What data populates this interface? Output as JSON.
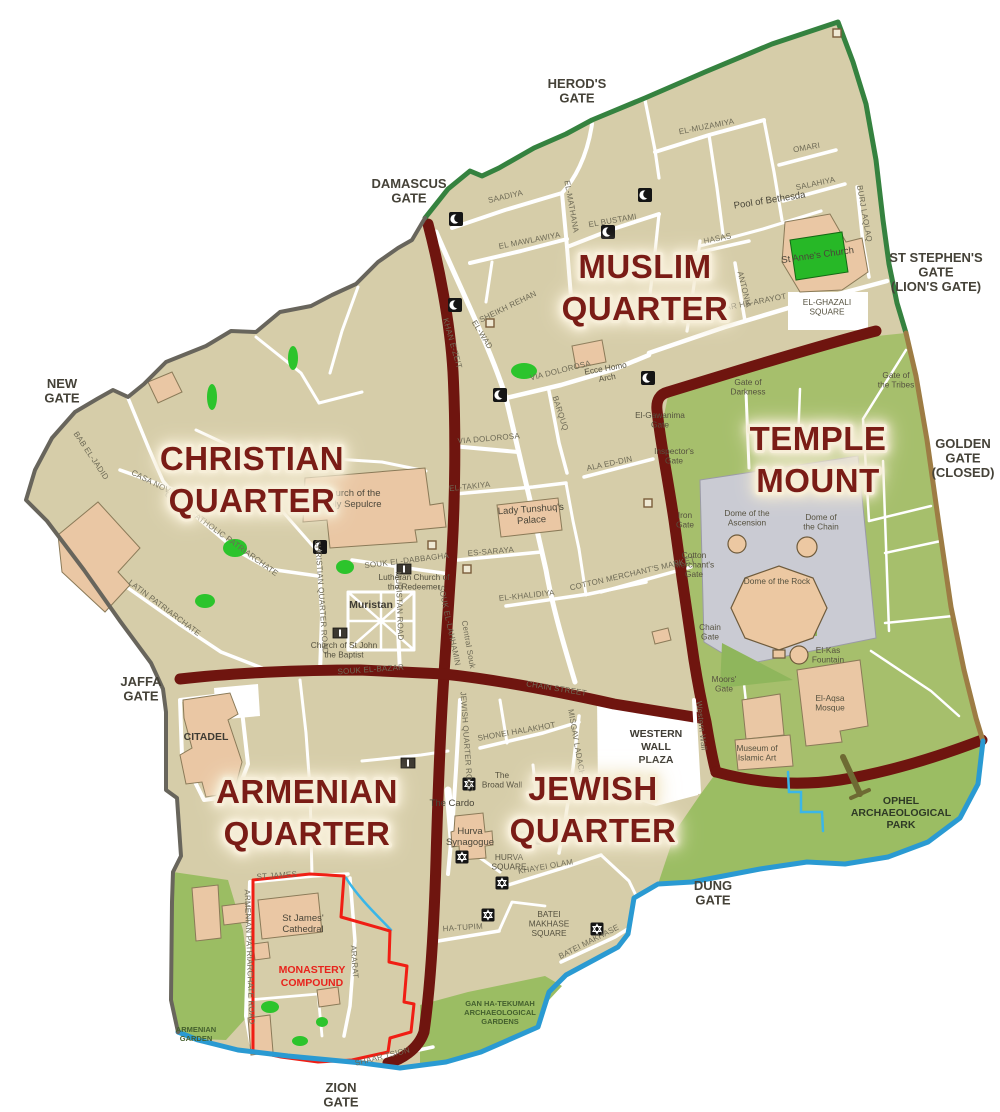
{
  "colors": {
    "background": "#ffffff",
    "land": "#d6cda9",
    "temple_mount_green": "#a6bf6c",
    "park_green": "#9bbd63",
    "tree_green": "#2cc42c",
    "building": "#eac7a4",
    "street": "#ffffff",
    "boundary_road": "#6f150f",
    "quarter_label": "#7a1e16",
    "quarter_glow": "#f6eed8",
    "wall_north": "#35823f",
    "wall_east": "#9d7c44",
    "wall_south": "#2a9ad2",
    "wall_west": "#68655c",
    "monastery_outline": "#f01e14",
    "esplanade": "#cacbd3"
  },
  "map": {
    "quarter_labels": [
      {
        "name": "muslim-quarter-label",
        "x": 645,
        "y": 278,
        "lines": [
          "MUSLIM",
          "QUARTER"
        ]
      },
      {
        "name": "christian-quarter-label",
        "x": 252,
        "y": 470,
        "lines": [
          "CHRISTIAN",
          "QUARTER"
        ]
      },
      {
        "name": "temple-mount-label",
        "x": 818,
        "y": 450,
        "lines": [
          "TEMPLE",
          "MOUNT"
        ]
      },
      {
        "name": "armenian-quarter-label",
        "x": 307,
        "y": 803,
        "lines": [
          "ARMENIAN",
          "QUARTER"
        ]
      },
      {
        "name": "jewish-quarter-label",
        "x": 593,
        "y": 800,
        "lines": [
          "JEWISH",
          "QUARTER"
        ]
      }
    ],
    "gate_labels": [
      {
        "name": "herods-gate-label",
        "x": 577,
        "y": 88,
        "lines": [
          "HEROD'S",
          "GATE"
        ]
      },
      {
        "name": "damascus-gate-label",
        "x": 409,
        "y": 188,
        "lines": [
          "DAMASCUS",
          "GATE"
        ]
      },
      {
        "name": "st-stephens-gate-label",
        "x": 936,
        "y": 262,
        "lines": [
          "ST STEPHEN'S",
          "GATE",
          "(LION'S GATE)"
        ]
      },
      {
        "name": "golden-gate-label",
        "x": 963,
        "y": 448,
        "lines": [
          "GOLDEN",
          "GATE",
          "(CLOSED)"
        ]
      },
      {
        "name": "new-gate-label",
        "x": 62,
        "y": 388,
        "lines": [
          "NEW",
          "GATE"
        ]
      },
      {
        "name": "jaffa-gate-label",
        "x": 141,
        "y": 686,
        "lines": [
          "JAFFA",
          "GATE"
        ]
      },
      {
        "name": "zion-gate-label",
        "x": 341,
        "y": 1092,
        "lines": [
          "ZION",
          "GATE"
        ]
      },
      {
        "name": "dung-gate-label",
        "x": 713,
        "y": 890,
        "lines": [
          "DUNG",
          "GATE"
        ]
      }
    ],
    "landmark_labels": [
      {
        "name": "pool-of-bethesda-label",
        "x": 770,
        "y": 203,
        "r": -9,
        "cls": "landmark",
        "lines": [
          "Pool of Bethesda"
        ]
      },
      {
        "name": "st-annes-church-label",
        "x": 818,
        "y": 258,
        "r": -8,
        "cls": "landmark",
        "lines": [
          "St Anne's Church"
        ]
      },
      {
        "name": "el-ghazali-square-label",
        "x": 827,
        "y": 305,
        "cls": "tiny",
        "lines": [
          "EL-GHAZALI",
          "SQUARE"
        ]
      },
      {
        "name": "ecce-homo-arch-label",
        "x": 606,
        "y": 371,
        "r": -10,
        "cls": "tiny",
        "lines": [
          "Ecce Homo",
          "Arch"
        ]
      },
      {
        "name": "lady-tunshuq-palace-label",
        "x": 531,
        "y": 512,
        "r": -4,
        "cls": "landmark",
        "lines": [
          "Lady Tunshuq's",
          "Palace"
        ]
      },
      {
        "name": "holy-sepulchre-label",
        "x": 352,
        "y": 496,
        "cls": "landmark",
        "lines": [
          "Church of the",
          "Holy Sepulcre"
        ]
      },
      {
        "name": "lutheran-redeemer-label",
        "x": 414,
        "y": 580,
        "cls": "tiny",
        "lines": [
          "Lutheran Church of",
          "the Redeemer"
        ]
      },
      {
        "name": "muristan-label",
        "x": 371,
        "y": 608,
        "cls": "landmark-bold",
        "lines": [
          "Muristan"
        ]
      },
      {
        "name": "st-john-baptist-label",
        "x": 344,
        "y": 648,
        "cls": "tiny",
        "lines": [
          "Church of St John",
          "the Baptist"
        ]
      },
      {
        "name": "citadel-label",
        "x": 206,
        "y": 740,
        "cls": "landmark-bold",
        "lines": [
          "CITADEL"
        ]
      },
      {
        "name": "western-wall-plaza-label",
        "x": 656,
        "y": 737,
        "cls": "landmark-bold",
        "lines": [
          "WESTERN",
          "WALL",
          "PLAZA"
        ]
      },
      {
        "name": "dome-of-ascension-label",
        "x": 747,
        "y": 516,
        "cls": "tiny",
        "lines": [
          "Dome of the",
          "Ascension"
        ]
      },
      {
        "name": "dome-of-chain-label",
        "x": 821,
        "y": 520,
        "cls": "tiny",
        "lines": [
          "Dome of",
          "the Chain"
        ]
      },
      {
        "name": "dome-of-rock-label",
        "x": 777,
        "y": 584,
        "cls": "tiny",
        "lines": [
          "Dome of the Rock"
        ]
      },
      {
        "name": "el-kas-fountain-label",
        "x": 828,
        "y": 653,
        "cls": "tiny",
        "lines": [
          "El-Kas",
          "Fountain"
        ]
      },
      {
        "name": "el-aqsa-mosque-label",
        "x": 830,
        "y": 701,
        "cls": "tiny",
        "lines": [
          "El-Aqsa",
          "Mosque"
        ]
      },
      {
        "name": "museum-islamic-art-label",
        "x": 757,
        "y": 751,
        "cls": "tiny",
        "lines": [
          "Museum of",
          "Islamic Art"
        ]
      },
      {
        "name": "ophel-park-label",
        "x": 901,
        "y": 804,
        "cls": "green-bold",
        "lines": [
          "OPHEL",
          "ARCHAEOLOGICAL",
          "PARK"
        ]
      },
      {
        "name": "gan-ha-tekumah-label",
        "x": 500,
        "y": 1006,
        "cls": "green-tiny",
        "lines": [
          "GAN HA-TEKUMAH",
          "ARCHAEOLOGICAL",
          "GARDENS"
        ]
      },
      {
        "name": "armenian-garden-label",
        "x": 196,
        "y": 1032,
        "cls": "green-tiny",
        "lines": [
          "ARMENIAN",
          "GARDEN"
        ]
      },
      {
        "name": "st-james-cathedral-label",
        "x": 303,
        "y": 921,
        "cls": "landmark",
        "lines": [
          "St James'",
          "Cathedral"
        ]
      },
      {
        "name": "monastery-compound-label",
        "x": 312,
        "y": 973,
        "cls": "red-bold",
        "lines": [
          "MONASTERY",
          "COMPOUND"
        ]
      },
      {
        "name": "the-cardo-label",
        "x": 452,
        "y": 806,
        "cls": "landmark",
        "lines": [
          "The Cardo"
        ]
      },
      {
        "name": "broad-wall-label",
        "x": 502,
        "y": 778,
        "cls": "tiny",
        "lines": [
          "The",
          "Broad Wall"
        ]
      },
      {
        "name": "hurva-synagogue-label",
        "x": 470,
        "y": 834,
        "cls": "landmark",
        "lines": [
          "Hurva",
          "Synagogue"
        ]
      },
      {
        "name": "hurva-square-label",
        "x": 509,
        "y": 860,
        "cls": "tiny",
        "lines": [
          "HURVA",
          "SQUARE"
        ]
      },
      {
        "name": "batei-makhase-square-label",
        "x": 549,
        "y": 917,
        "cls": "tiny",
        "lines": [
          "BATEI",
          "MAKHASE",
          "SQUARE"
        ]
      },
      {
        "name": "gate-of-tribes-label",
        "x": 896,
        "y": 378,
        "cls": "tiny",
        "lines": [
          "Gate of",
          "the Tribes"
        ]
      },
      {
        "name": "gate-of-darkness-label",
        "x": 748,
        "y": 385,
        "cls": "tiny",
        "lines": [
          "Gate of",
          "Darkness"
        ]
      },
      {
        "name": "el-gawanima-gate-label",
        "x": 660,
        "y": 418,
        "cls": "tiny",
        "lines": [
          "El-Gawanima",
          "Gate"
        ]
      },
      {
        "name": "inspectors-gate-label",
        "x": 674,
        "y": 454,
        "cls": "tiny",
        "lines": [
          "Inspector's",
          "Gate"
        ]
      },
      {
        "name": "iron-gate-label",
        "x": 685,
        "y": 518,
        "cls": "tiny",
        "lines": [
          "Iron",
          "Gate"
        ]
      },
      {
        "name": "cotton-merchants-gate-label",
        "x": 694,
        "y": 558,
        "cls": "tiny",
        "lines": [
          "Cotton",
          "Merchant's",
          "Gate"
        ]
      },
      {
        "name": "chain-gate-label",
        "x": 710,
        "y": 630,
        "cls": "tiny",
        "lines": [
          "Chain",
          "Gate"
        ]
      },
      {
        "name": "moors-gate-label",
        "x": 724,
        "y": 682,
        "cls": "tiny",
        "lines": [
          "Moors'",
          "Gate"
        ]
      },
      {
        "name": "western-wall-label",
        "x": 699,
        "y": 726,
        "r": 84,
        "cls": "street",
        "lines": [
          "Western Wall"
        ]
      }
    ],
    "street_labels": [
      {
        "name": "saadiya-street",
        "x": 506,
        "y": 199,
        "r": -13,
        "text": "SAADIYA"
      },
      {
        "name": "el-mathana-street",
        "x": 569,
        "y": 207,
        "r": 80,
        "text": "EL-MATHANA"
      },
      {
        "name": "el-bustami-street",
        "x": 613,
        "y": 223,
        "r": -10,
        "text": "EL BUSTAMI"
      },
      {
        "name": "el-mawlawiya-street",
        "x": 530,
        "y": 243,
        "r": -11,
        "text": "EL MAWLAWIYA"
      },
      {
        "name": "el-muzamiya-street",
        "x": 707,
        "y": 129,
        "r": -11,
        "text": "EL-MUZAMIYA"
      },
      {
        "name": "omari-street",
        "x": 807,
        "y": 150,
        "r": -10,
        "text": "OMARI"
      },
      {
        "name": "salahiya-street",
        "x": 816,
        "y": 186,
        "r": -12,
        "text": "SALAHIYA"
      },
      {
        "name": "burj-laqlaq-street",
        "x": 862,
        "y": 214,
        "r": 80,
        "text": "BURJ LAQLAQ"
      },
      {
        "name": "hasas-street",
        "x": 718,
        "y": 241,
        "r": -12,
        "text": "HASAS"
      },
      {
        "name": "antonia-street",
        "x": 742,
        "y": 290,
        "r": 76,
        "text": "ANTONIA"
      },
      {
        "name": "shaar-ha-arayot-street",
        "x": 748,
        "y": 306,
        "r": -11,
        "text": "SHAAR HA-ARAYOT"
      },
      {
        "name": "sheikh-rehan-street",
        "x": 509,
        "y": 309,
        "r": -26,
        "text": "SHEIKH REHAN"
      },
      {
        "name": "el-wad-street",
        "x": 480,
        "y": 336,
        "r": 58,
        "text": "EL-WAD"
      },
      {
        "name": "via-dolorosa-east-street",
        "x": 561,
        "y": 373,
        "r": -14,
        "text": "VIA DOLOROSA"
      },
      {
        "name": "barquq-street",
        "x": 558,
        "y": 414,
        "r": 72,
        "text": "BARQUQ"
      },
      {
        "name": "via-dolorosa-west-street",
        "x": 489,
        "y": 441,
        "r": -5,
        "text": "VIA DOLOROSA"
      },
      {
        "name": "ala-ed-din-street",
        "x": 610,
        "y": 466,
        "r": -12,
        "text": "ALA ED-DIN"
      },
      {
        "name": "el-takiya-street",
        "x": 470,
        "y": 489,
        "r": -6,
        "text": "EL-TAKIYA"
      },
      {
        "name": "es-saraya-street",
        "x": 491,
        "y": 554,
        "r": -5,
        "text": "ES-SARAYA"
      },
      {
        "name": "el-khalidiya-street",
        "x": 527,
        "y": 598,
        "r": -6,
        "text": "EL-KHALIDIYA"
      },
      {
        "name": "cotton-merchants-market-street",
        "x": 633,
        "y": 576,
        "r": -13,
        "text": "COTTON MERCHANT'S MARKET"
      },
      {
        "name": "souk-el-dabbagha-street",
        "x": 407,
        "y": 563,
        "r": -7,
        "text": "SOUK EL-DABBAGHA"
      },
      {
        "name": "christian-quarter-road-street",
        "x": 319,
        "y": 597,
        "r": 86,
        "text": "CHRISTIAN QUARTER ROAD"
      },
      {
        "name": "muristan-road-street",
        "x": 397,
        "y": 606,
        "r": 88,
        "text": "MURISTAN ROAD"
      },
      {
        "name": "souk-el-lahhamin-street",
        "x": 447,
        "y": 626,
        "r": 78,
        "text": "SOUK EL-LAHHAMIN"
      },
      {
        "name": "central-souk-street",
        "x": 466,
        "y": 645,
        "r": 80,
        "text": "Central Souk"
      },
      {
        "name": "khan-e-zeit-street",
        "x": 450,
        "y": 344,
        "r": 74,
        "text": "KHAN E-ZEIT"
      },
      {
        "name": "greek-catholic-patriarchate-street",
        "x": 220,
        "y": 536,
        "r": 36,
        "text": "GREEK CATHOLIC PATRIARCHATE"
      },
      {
        "name": "casa-nova-street",
        "x": 152,
        "y": 485,
        "r": 27,
        "text": "CASA NOVA"
      },
      {
        "name": "bab-el-jadid-street",
        "x": 89,
        "y": 457,
        "r": 56,
        "text": "BAB EL-JADID"
      },
      {
        "name": "latin-patriarchate-street",
        "x": 163,
        "y": 610,
        "r": 37,
        "text": "LATIN PATRIARCHATE"
      },
      {
        "name": "el-khanqa-street",
        "x": 308,
        "y": 456,
        "r": -6,
        "text": "EL-KHANQA"
      },
      {
        "name": "souk-el-bazar-street",
        "x": 371,
        "y": 672,
        "r": -4,
        "text": "SOUK EL-BAZAR"
      },
      {
        "name": "chain-street-street",
        "x": 556,
        "y": 691,
        "r": 9,
        "text": "CHAIN STREET"
      },
      {
        "name": "jewish-quarter-road-street",
        "x": 464,
        "y": 742,
        "r": 86,
        "text": "JEWISH QUARTER ROAD"
      },
      {
        "name": "shonei-halakhot-street",
        "x": 517,
        "y": 734,
        "r": -10,
        "text": "SHONEI HALAKHOT"
      },
      {
        "name": "misgav-ladach-street",
        "x": 574,
        "y": 743,
        "r": 80,
        "text": "MISGAV LADACH"
      },
      {
        "name": "khayei-olam-street",
        "x": 546,
        "y": 869,
        "r": -10,
        "text": "KHAYEI OLAM"
      },
      {
        "name": "batei-makhase-street",
        "x": 590,
        "y": 944,
        "r": -27,
        "text": "BATEI MAKHASE"
      },
      {
        "name": "ha-tupim-street",
        "x": 463,
        "y": 930,
        "r": -4,
        "text": "HA-TUPIM"
      },
      {
        "name": "st-james-street",
        "x": 277,
        "y": 878,
        "r": -4,
        "text": "ST JAMES"
      },
      {
        "name": "armenian-patriarchate-road-street",
        "x": 247,
        "y": 957,
        "r": 88,
        "text": "ARMENIAN PATRIARCHATE ROAD"
      },
      {
        "name": "ararat-street",
        "x": 352,
        "y": 962,
        "r": 86,
        "text": "ARARAT"
      },
      {
        "name": "shaar-tsion-street",
        "x": 383,
        "y": 1059,
        "r": -14,
        "text": "SHAAR TSION"
      }
    ],
    "icons": {
      "mosques": [
        [
          456,
          219
        ],
        [
          645,
          195
        ],
        [
          608,
          232
        ],
        [
          455,
          305
        ],
        [
          500,
          395
        ],
        [
          648,
          378
        ],
        [
          320,
          547
        ]
      ],
      "synagogues": [
        [
          469,
          784
        ],
        [
          462,
          857
        ],
        [
          523,
          838
        ],
        [
          542,
          838
        ],
        [
          502,
          883
        ],
        [
          488,
          915
        ],
        [
          597,
          929
        ]
      ],
      "sites": [
        [
          490,
          323
        ],
        [
          467,
          569
        ],
        [
          837,
          33
        ],
        [
          648,
          503
        ],
        [
          432,
          545
        ]
      ],
      "churches": [
        [
          404,
          569
        ],
        [
          340,
          633
        ],
        [
          408,
          763
        ]
      ]
    }
  }
}
